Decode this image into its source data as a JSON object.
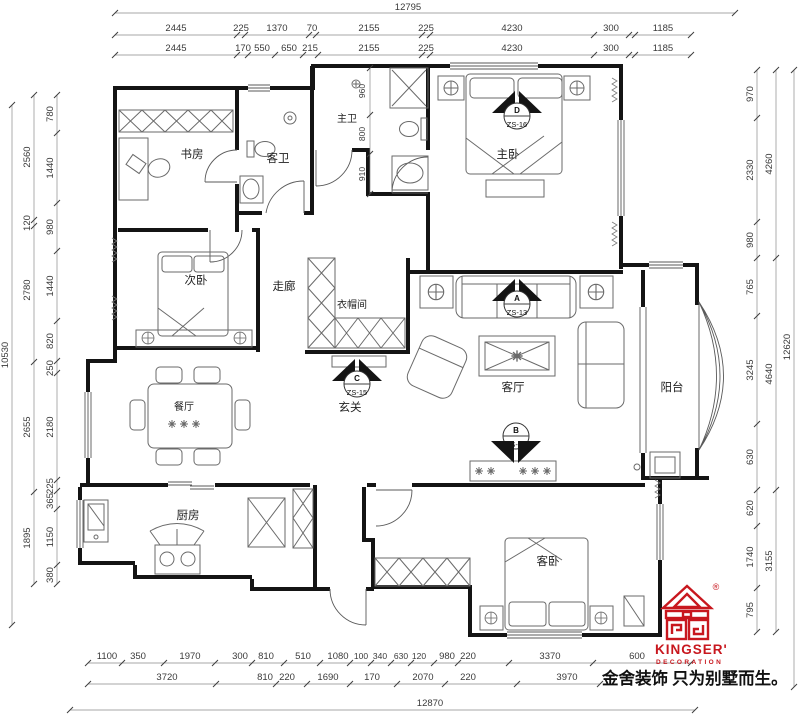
{
  "meta": {
    "background": "#ffffff",
    "line_color": "#141414",
    "accent_red": "#c8171e"
  },
  "rooms": {
    "study": "书房",
    "guest_bath": "客卫",
    "master_bath": "主卫",
    "master_bedroom": "主卧",
    "second_bedroom": "次卧",
    "corridor": "走廊",
    "cloakroom": "衣帽间",
    "living": "客厅",
    "balcony": "阳台",
    "dining": "餐厅",
    "foyer": "玄关",
    "kitchen": "厨房",
    "guest_bedroom": "客卧"
  },
  "markers": {
    "zs13": {
      "letter": "A",
      "code": "ZS-13"
    },
    "zs14": {
      "letter": "B",
      "code": "ZS-14"
    },
    "zs15": {
      "letter": "C",
      "code": "ZS-15"
    },
    "zs16": {
      "letter": "D",
      "code": "ZS-16"
    }
  },
  "interior_dims": {
    "mb1": "960",
    "mb2": "800",
    "mb3": "910"
  },
  "dims": {
    "top": {
      "total": "12795",
      "row1": [
        "2445",
        "225",
        "1370",
        "70",
        "2155",
        "225",
        "4230",
        "300",
        "1185"
      ],
      "row2": [
        "2445",
        "170",
        "550",
        "650",
        "215",
        "2155",
        "225",
        "4230",
        "300",
        "1185"
      ]
    },
    "left": {
      "total": "10530",
      "mid": [
        "2560",
        "120",
        "2780",
        "2655",
        "1895"
      ],
      "inner": [
        "780",
        "1440",
        "980",
        "1440",
        "820",
        "250",
        "2180",
        "225",
        "365",
        "1150",
        "380"
      ]
    },
    "right": {
      "total": "12620",
      "mid": [
        "4260",
        "4640",
        "3155"
      ],
      "inner": [
        "970",
        "2330",
        "980",
        "765",
        "3245",
        "630",
        "620",
        "1740",
        "795"
      ]
    },
    "bottom": {
      "total": "12870",
      "row1": [
        "1100",
        "350",
        "1970",
        "300",
        "810",
        "510",
        "1080",
        "100",
        "340",
        "630",
        "120",
        "980",
        "220",
        "3370",
        "600"
      ],
      "row2": [
        "3720",
        "810",
        "220",
        "1690",
        "170",
        "2070",
        "220",
        "3970"
      ]
    }
  },
  "logo": {
    "brand": "KINGSER'",
    "sub": "DECORATION",
    "registered": "®",
    "tagline": "金舍装饰 只为别墅而生。",
    "color": "#c8171e"
  }
}
